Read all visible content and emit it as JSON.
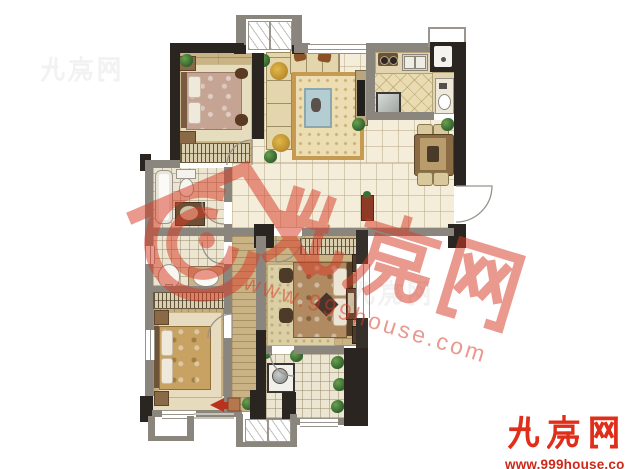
{
  "watermark": {
    "brand_glyphs": "九房网",
    "url_text": "www.999house.com",
    "color": "#d73c28",
    "house_icon": "house-spiral-icon"
  },
  "corner_logo": {
    "brand_glyphs": "九房网",
    "url_text": "www.999house.com",
    "color": "#df2f1b"
  },
  "palette": {
    "background": "#ffffff",
    "wall_dark": "#2b2521",
    "wall_gray": "#8a867e",
    "floor_tile": "#f3edda",
    "floor_wood": "#c9b284",
    "floor_kitchen": "#e9dcb2",
    "accent_red": "#d73c28"
  }
}
